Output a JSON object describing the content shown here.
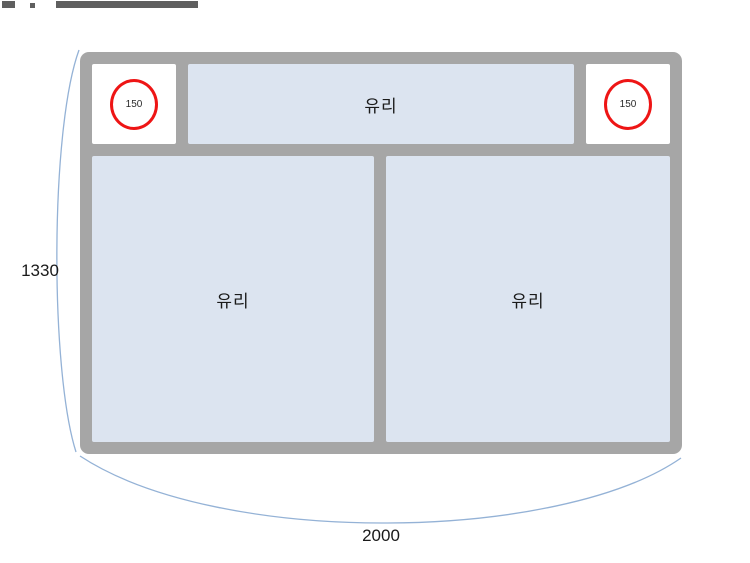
{
  "colors": {
    "frame_gray": "#a6a6a6",
    "glass_blue": "#dce4f0",
    "circle_red": "#ee1515",
    "dim_curve_blue": "#94b2d6",
    "text_dark": "#1a1a1a"
  },
  "frame": {
    "top_row": {
      "left_badge": "150",
      "glass_label": "유리",
      "right_badge": "150"
    },
    "bottom_row": {
      "left_glass_label": "유리",
      "right_glass_label": "유리"
    }
  },
  "dimensions": {
    "height_label": "1330",
    "width_label": "2000"
  }
}
